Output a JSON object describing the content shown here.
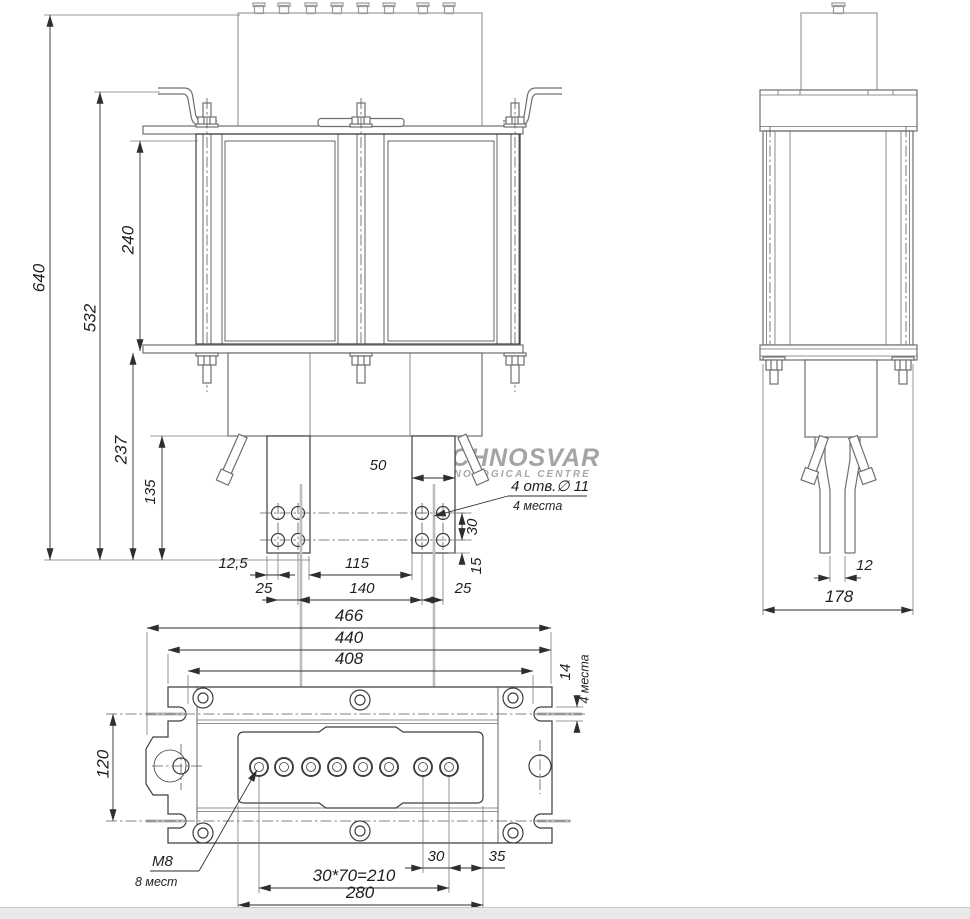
{
  "watermark": {
    "l1": "TECHNOSVAR",
    "l2": "TECHNOLOGICAL CENTRE"
  },
  "front": {
    "dims": {
      "h640": "640",
      "h532": "532",
      "h240": "240",
      "h237": "237",
      "h135": "135",
      "w50": "50",
      "w12_5": "12,5",
      "w25l": "25",
      "w115": "115",
      "w140": "140",
      "w25r": "25",
      "v30": "30",
      "v15": "15"
    },
    "callout": {
      "l1": "4 отв.∅ 11",
      "l2": "4 места"
    }
  },
  "side": {
    "dims": {
      "gap12": "12",
      "w178": "178"
    }
  },
  "bottom": {
    "dims": {
      "w466": "466",
      "w440": "440",
      "w408": "408",
      "slot14": "14",
      "slot_note": "4 места",
      "h120": "120",
      "row": "30*70=210",
      "w30": "30",
      "w35": "35",
      "w280": "280"
    },
    "callout": {
      "l1": "M8",
      "l2": "8 мест"
    }
  }
}
